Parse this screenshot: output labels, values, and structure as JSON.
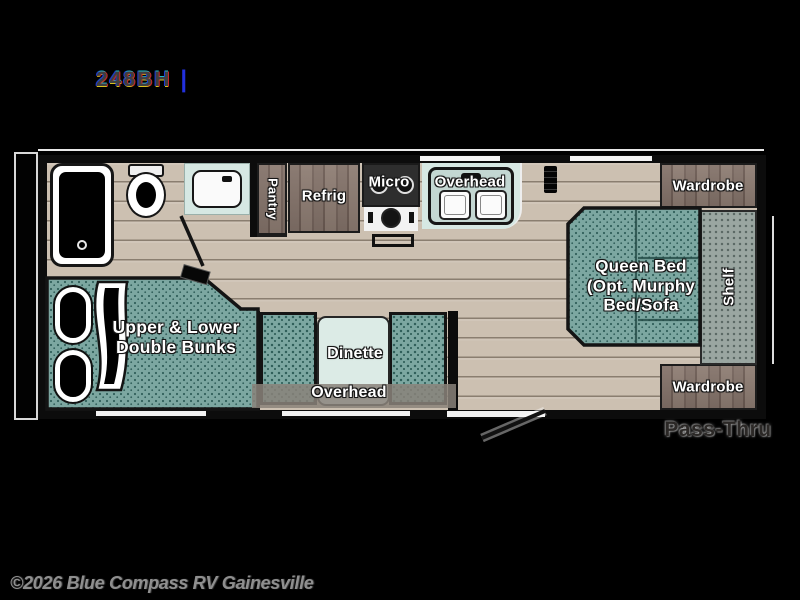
{
  "header": {
    "model": "248BH",
    "separator": "|"
  },
  "labels": {
    "pantry": "Pantry",
    "refrig": "Refrig",
    "micro": "Micro",
    "kitchen_overhead": "Overhead",
    "wardrobe_top": "Wardrobe",
    "wardrobe_bottom": "Wardrobe",
    "queen_bed_1": "Queen Bed",
    "queen_bed_2": "(Opt. Murphy",
    "queen_bed_3": "Bed/Sofa",
    "shelf": "Shelf",
    "bunks_1": "Upper & Lower",
    "bunks_2": "Double Bunks",
    "dinette": "Dinette",
    "dinette_overhead": "Overhead",
    "pass_thru": "Pass-Thru"
  },
  "footer": {
    "copyright": "©2026 Blue Compass RV Gainesville"
  },
  "colors": {
    "background": "#000000",
    "floor": "#ccc0b1",
    "floor_line": "#a3978a",
    "upholstery_teal": "#7ca7a1",
    "upholstery_dot": "#31605b",
    "counter_mint": "#d6e8e3",
    "wood": "#7d6c63",
    "shelf_gray": "#9aa6a1",
    "wall": "#0c0c0c",
    "label_text": "#ffffff",
    "pass_thru_text": "#2b2826",
    "copyright_text": "#8f8f8f"
  }
}
